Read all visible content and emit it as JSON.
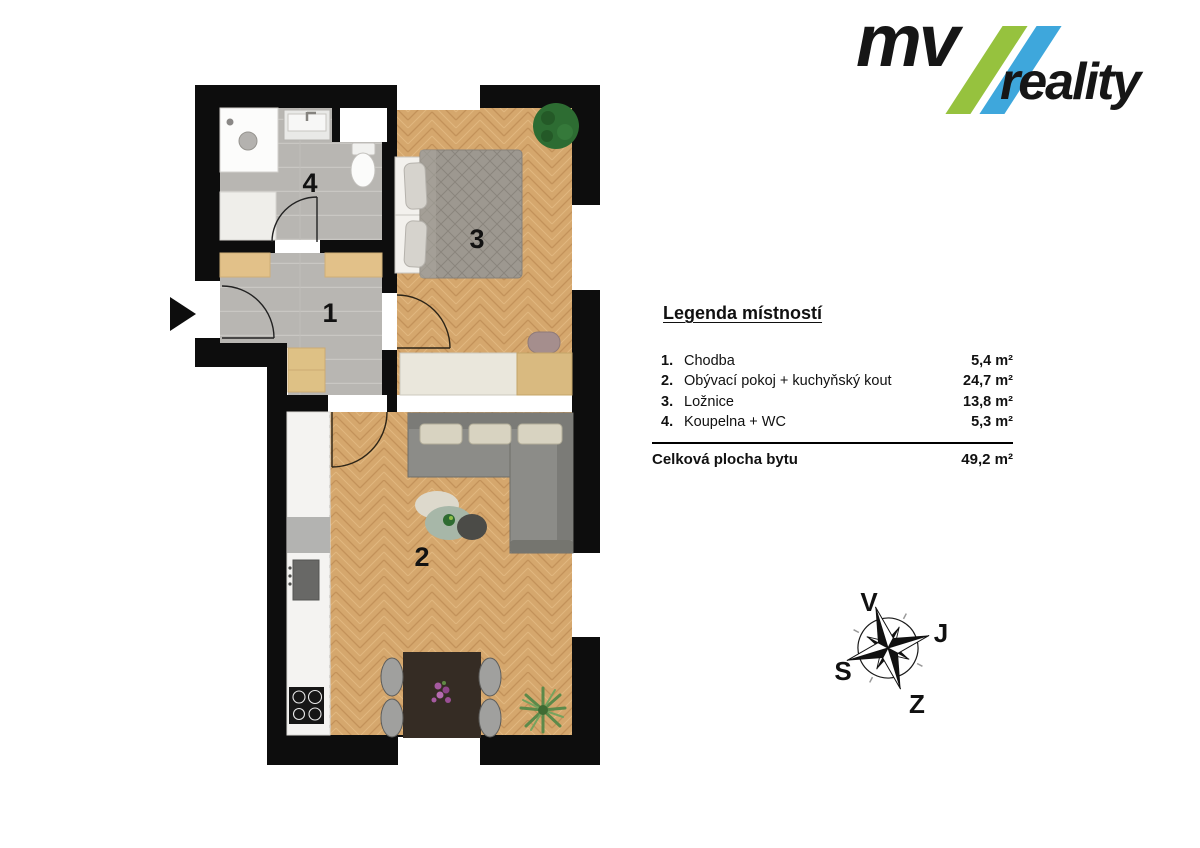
{
  "logo": {
    "mv": "mv",
    "reality": "reality",
    "slash_green": "#96c23e",
    "slash_blue": "#3ea7dc"
  },
  "legend": {
    "title": "Legenda místností",
    "rows": [
      {
        "num": "1.",
        "name": "Chodba",
        "area": "5,4 m²"
      },
      {
        "num": "2.",
        "name": "Obývací pokoj + kuchyňský kout",
        "area": "24,7 m²"
      },
      {
        "num": "3.",
        "name": "Ložnice",
        "area": "13,8 m²"
      },
      {
        "num": "4.",
        "name": "Koupelna + WC",
        "area": "5,3 m²"
      }
    ],
    "total": {
      "label": "Celková plocha bytu",
      "area": "49,2 m²"
    }
  },
  "compass": {
    "letters": {
      "top": "V",
      "right": "J",
      "bottom": "Z",
      "left": "S"
    }
  },
  "plan": {
    "rooms": [
      {
        "number": "1",
        "name": "Chodba"
      },
      {
        "number": "2",
        "name": "Obývací pokoj + kuchyňský kout"
      },
      {
        "number": "3",
        "name": "Ložnice"
      },
      {
        "number": "4",
        "name": "Koupelna + WC"
      }
    ]
  }
}
